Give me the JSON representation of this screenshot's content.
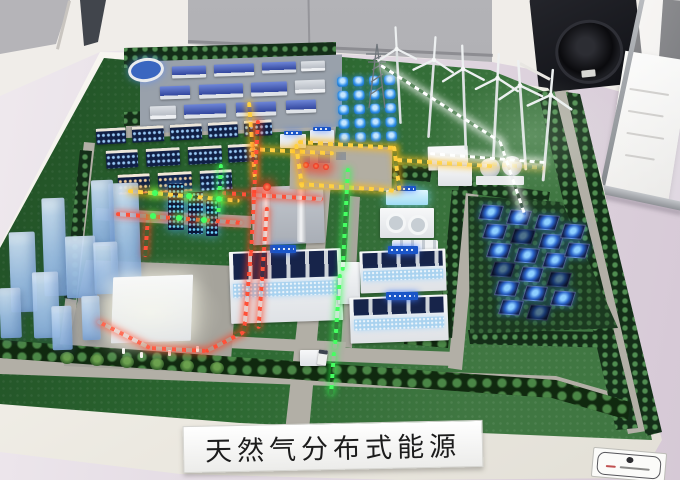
{
  "scene": {
    "kind": "photograph of an exhibition scale model (sand table) of a natural gas distributed energy park",
    "sign": {
      "text": "天然气分布式能源"
    },
    "counts": {
      "wind_turbines": 6,
      "solar_panels": 19,
      "blue_led_cells": 20
    },
    "colors": {
      "turf": "#2c6831",
      "table": "#f5f3ee",
      "floor": "#e5dde5",
      "wall": "#f0ede9",
      "display_panel": "#a9a9ad",
      "speaker": "#17181c",
      "led_yellow": "#ffc118",
      "led_red": "#ff4330",
      "led_green": "#3cf55a",
      "led_blue": "#35a0ff",
      "led_white": "#ffffff",
      "warehouse_roof": "#3550b0",
      "skyscraper_glass": "#aecbec",
      "solar_glow": "#55b8ff",
      "chimney_light": "#ff2a1a"
    }
  }
}
